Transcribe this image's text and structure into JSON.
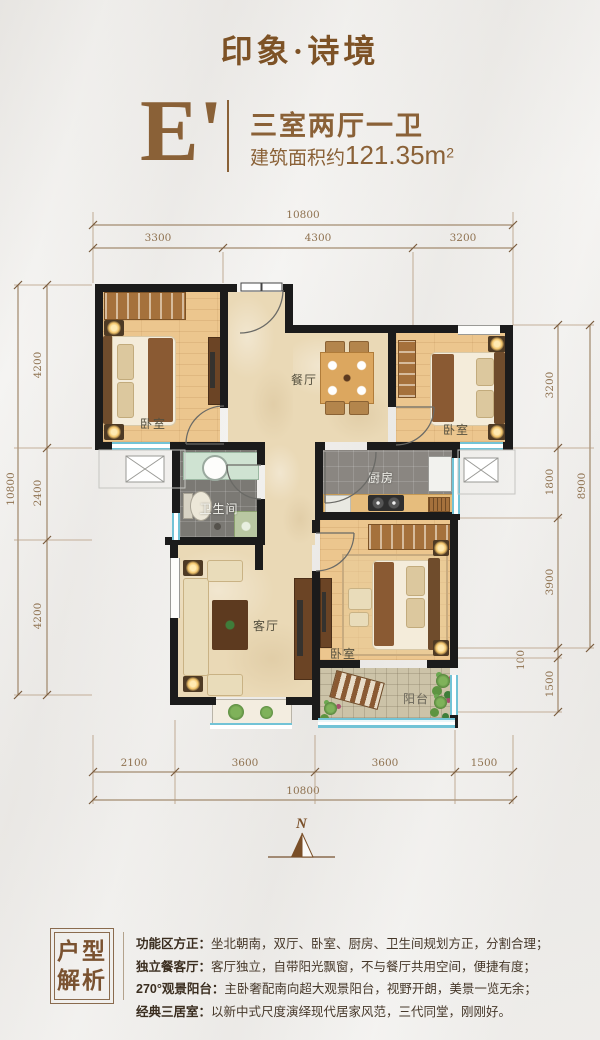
{
  "header": {
    "brand": "印象·诗境",
    "unit": "E'",
    "layout_type": "三室两厅一卫",
    "area_prefix": "建筑面积约",
    "area_value": "121.35m",
    "area_sup": "2"
  },
  "plan": {
    "compass": "N",
    "rooms": {
      "bedroom_left": "卧室",
      "bedroom_right": "卧室",
      "bedroom_master": "卧室",
      "dining": "餐厅",
      "living": "客厅",
      "kitchen": "厨房",
      "bathroom": "卫生间",
      "balcony": "阳台"
    },
    "dims": {
      "top_total": "10800",
      "top": [
        "3300",
        "4300",
        "3200"
      ],
      "left_total": "10800",
      "left": [
        "4200",
        "2400",
        "4200"
      ],
      "right_total": "8900",
      "right": [
        "3200",
        "1800",
        "3900",
        "100",
        "1500"
      ],
      "bottom_total": "10800",
      "bottom": [
        "2100",
        "3600",
        "3600",
        "1500"
      ]
    }
  },
  "analysis": {
    "box_title": [
      "户型",
      "解析"
    ],
    "items": [
      {
        "label": "功能区方正：",
        "text": "坐北朝南，双厅、卧室、厨房、卫生间规划方正，分割合理；"
      },
      {
        "label": "独立餐客厅：",
        "text": "客厅独立，自带阳光飘窗，不与餐厅共用空间，便捷有度；"
      },
      {
        "label": "270°观景阳台：",
        "text": "主卧奢配南向超大观景阳台，视野开朗，美景一览无余；"
      },
      {
        "label": "经典三居室：",
        "text": "以新中式尺度演绎现代居家风范，三代同堂，刚刚好。"
      }
    ]
  },
  "colors": {
    "brand_brown": "#7d5226",
    "accent_brown": "#8a6137",
    "dim_line": "#8f7250",
    "wall": "#1b1b1b",
    "window_cyan": "#72c3d6",
    "wood_floor": "#ecc68e",
    "marble_floor": "#ead9b6"
  }
}
